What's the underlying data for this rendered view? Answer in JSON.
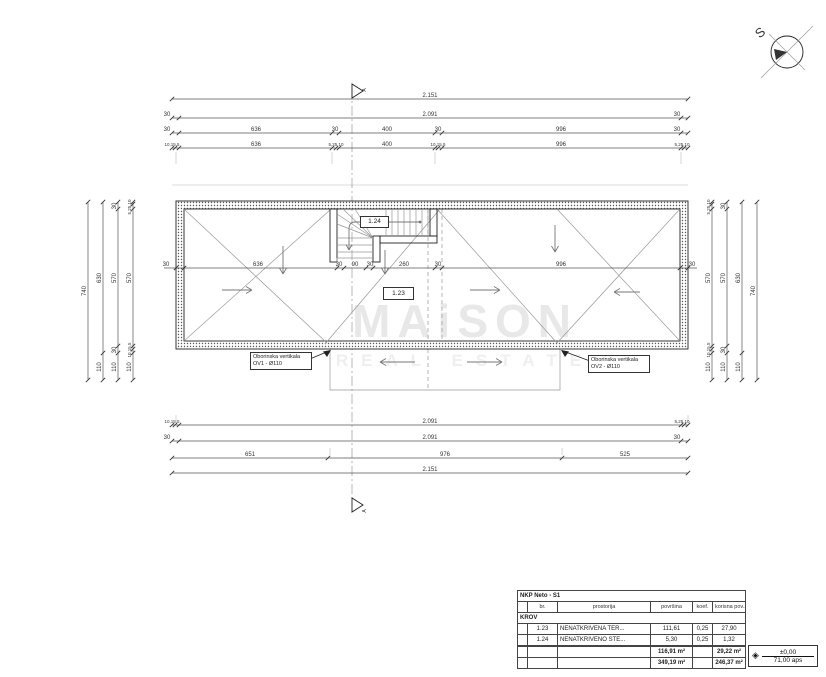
{
  "watermark": {
    "line1": "MAiSON",
    "line2": "REAL ESTATE"
  },
  "north_label": "S",
  "section_marker": "A",
  "room_labels": {
    "stair": "1.24",
    "terrace": "1.23"
  },
  "ov1": {
    "line1": "Oborinska vertikala",
    "line2": "OV1 - Ø110"
  },
  "ov2": {
    "line1": "Oborinska vertikala",
    "line2": "OV2 - Ø110"
  },
  "elevation": {
    "top": "±0,00",
    "bottom": "71,00 aps"
  },
  "table": {
    "title": "NKP Neto - S1",
    "headers": [
      "",
      "br.",
      "prostorija",
      "površina",
      "koef.",
      "korisna pov..."
    ],
    "section": "KROV",
    "rows": [
      {
        "br": "1.23",
        "name": "NENATKRIVENA TER...",
        "area": "111,61",
        "koef": "0,25",
        "korisna": "27,90"
      },
      {
        "br": "1.24",
        "name": "NENATKRIVENO STE...",
        "area": "5,30",
        "koef": "0,25",
        "korisna": "1,32"
      }
    ],
    "subtotal": {
      "area": "116,91 m²",
      "korisna": "29,22 m²"
    },
    "total": {
      "area": "349,19 m²",
      "korisna": "246,37 m²"
    }
  },
  "dimensions": {
    "horizontal": [
      {
        "y": 99,
        "x1": 172,
        "x2": 688,
        "ticks": [
          172,
          688
        ],
        "labels": [
          {
            "t": "2.151",
            "x": 430
          }
        ]
      },
      {
        "y": 118,
        "x1": 172,
        "x2": 688,
        "ticks": [
          172,
          179,
          681,
          688
        ],
        "labels": [
          {
            "t": "30",
            "x": 167
          },
          {
            "t": "2.091",
            "x": 430
          },
          {
            "t": "30",
            "x": 677
          }
        ]
      },
      {
        "y": 133,
        "x1": 172,
        "x2": 688,
        "ticks": [
          172,
          179,
          332,
          339,
          435,
          442,
          681,
          688
        ],
        "labels": [
          {
            "t": "30",
            "x": 167
          },
          {
            "t": "636",
            "x": 256
          },
          {
            "t": "30",
            "x": 335
          },
          {
            "t": "400",
            "x": 387
          },
          {
            "t": "30",
            "x": 438
          },
          {
            "t": "996",
            "x": 561
          },
          {
            "t": "30",
            "x": 677
          }
        ]
      },
      {
        "y": 148,
        "x1": 172,
        "x2": 688,
        "ticks": [
          172,
          175,
          179,
          332,
          336,
          339,
          435,
          438,
          442,
          681,
          684,
          688
        ],
        "labels": [
          {
            "t": "10,15,5",
            "x": 172,
            "s": 4.5
          },
          {
            "t": "636",
            "x": 256
          },
          {
            "t": "5,25,10",
            "x": 336,
            "s": 4.5
          },
          {
            "t": "400",
            "x": 387
          },
          {
            "t": "10,15,5",
            "x": 438,
            "s": 4.5
          },
          {
            "t": "996",
            "x": 561
          },
          {
            "t": "5,25,10",
            "x": 682,
            "s": 4.5
          }
        ]
      },
      {
        "y": 268,
        "x1": 164,
        "x2": 697,
        "ticks": [
          176,
          184,
          337,
          344,
          366,
          373,
          435,
          442,
          680,
          688
        ],
        "labels": [
          {
            "t": "30",
            "x": 166
          },
          {
            "t": "636",
            "x": 258
          },
          {
            "t": "30",
            "x": 339
          },
          {
            "t": "90",
            "x": 355
          },
          {
            "t": "30",
            "x": 370
          },
          {
            "t": "260",
            "x": 404
          },
          {
            "t": "30",
            "x": 438
          },
          {
            "t": "996",
            "x": 561
          },
          {
            "t": "30",
            "x": 692
          }
        ]
      },
      {
        "y": 425,
        "x1": 172,
        "x2": 688,
        "ticks": [
          172,
          175,
          179,
          681,
          684,
          688
        ],
        "labels": [
          {
            "t": "10,15,5",
            "x": 172,
            "s": 4.5
          },
          {
            "t": "2.091",
            "x": 430
          },
          {
            "t": "5,25,10",
            "x": 682,
            "s": 4.5
          }
        ]
      },
      {
        "y": 441,
        "x1": 172,
        "x2": 688,
        "ticks": [
          172,
          179,
          681,
          688
        ],
        "labels": [
          {
            "t": "30",
            "x": 167
          },
          {
            "t": "2.091",
            "x": 430
          },
          {
            "t": "30",
            "x": 677
          }
        ]
      },
      {
        "y": 458,
        "x1": 172,
        "x2": 688,
        "ticks": [
          172,
          328,
          562,
          688
        ],
        "labels": [
          {
            "t": "651",
            "x": 250
          },
          {
            "t": "976",
            "x": 445
          },
          {
            "t": "525",
            "x": 625
          }
        ]
      },
      {
        "y": 473,
        "x1": 172,
        "x2": 688,
        "ticks": [
          172,
          688
        ],
        "labels": [
          {
            "t": "2.151",
            "x": 430
          }
        ]
      }
    ],
    "vertical": [
      {
        "x": 88,
        "y1": 202,
        "y2": 380,
        "ticks": [
          202,
          380
        ],
        "labels": [
          {
            "t": "740",
            "y": 291
          }
        ]
      },
      {
        "x": 103,
        "y1": 202,
        "y2": 380,
        "ticks": [
          202,
          353,
          380
        ],
        "labels": [
          {
            "t": "630",
            "y": 278
          },
          {
            "t": "110",
            "y": 367
          }
        ]
      },
      {
        "x": 118,
        "y1": 202,
        "y2": 380,
        "ticks": [
          202,
          209,
          346,
          353,
          380
        ],
        "labels": [
          {
            "t": "30",
            "y": 206
          },
          {
            "t": "570",
            "y": 278
          },
          {
            "t": "30",
            "y": 350
          },
          {
            "t": "110",
            "y": 367
          }
        ]
      },
      {
        "x": 133,
        "y1": 202,
        "y2": 380,
        "ticks": [
          202,
          204,
          209,
          346,
          349,
          353,
          380
        ],
        "labels": [
          {
            "t": "5,25,10",
            "y": 207,
            "s": 4.5
          },
          {
            "t": "570",
            "y": 278
          },
          {
            "t": "10,15,5",
            "y": 350,
            "s": 4.5
          },
          {
            "t": "110",
            "y": 367
          }
        ]
      },
      {
        "x": 712,
        "y1": 202,
        "y2": 380,
        "ticks": [
          202,
          204,
          209,
          346,
          349,
          353,
          380
        ],
        "labels": [
          {
            "t": "5,25,10",
            "y": 207,
            "s": 4.5
          },
          {
            "t": "570",
            "y": 278
          },
          {
            "t": "10,15,5",
            "y": 350,
            "s": 4.5
          },
          {
            "t": "110",
            "y": 367
          }
        ]
      },
      {
        "x": 727,
        "y1": 202,
        "y2": 380,
        "ticks": [
          202,
          209,
          346,
          353,
          380
        ],
        "labels": [
          {
            "t": "30",
            "y": 206
          },
          {
            "t": "570",
            "y": 278
          },
          {
            "t": "30",
            "y": 350
          },
          {
            "t": "110",
            "y": 367
          }
        ]
      },
      {
        "x": 742,
        "y1": 202,
        "y2": 380,
        "ticks": [
          202,
          353,
          380
        ],
        "labels": [
          {
            "t": "630",
            "y": 278
          },
          {
            "t": "110",
            "y": 367
          }
        ]
      },
      {
        "x": 757,
        "y1": 202,
        "y2": 380,
        "ticks": [
          202,
          380
        ],
        "labels": [
          {
            "t": "740",
            "y": 291
          }
        ]
      }
    ]
  }
}
